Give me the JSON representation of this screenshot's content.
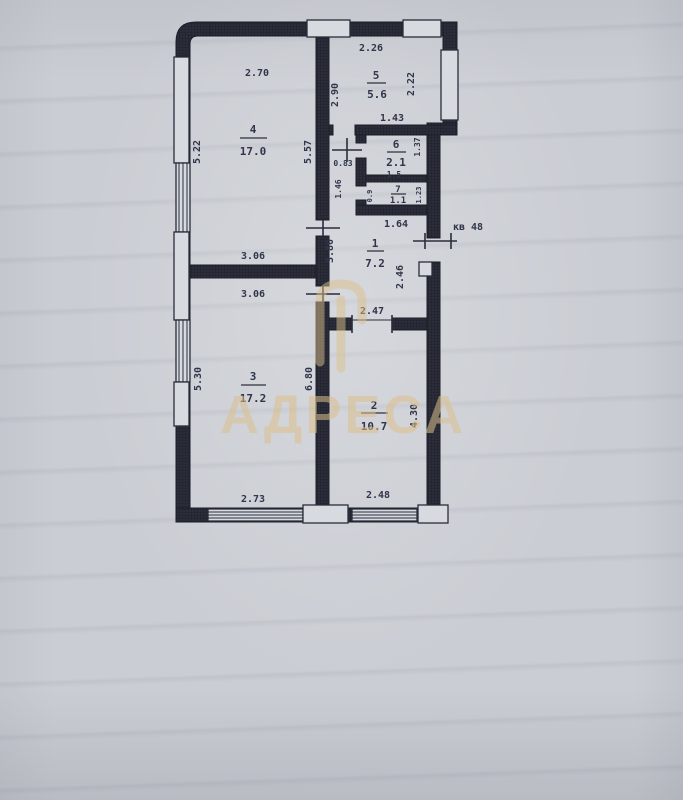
{
  "watermark": {
    "text": "АДРЕСА"
  },
  "annotations": {
    "apartment": "кв 48"
  },
  "rooms": [
    {
      "number": "1",
      "area": "7.2"
    },
    {
      "number": "2",
      "area": "10.7"
    },
    {
      "number": "3",
      "area": "17.2"
    },
    {
      "number": "4",
      "area": "17.0"
    },
    {
      "number": "5",
      "area": "5.6"
    },
    {
      "number": "6",
      "area": "2.1"
    },
    {
      "number": "7",
      "area": "1.1"
    }
  ],
  "dims": {
    "r4_top": "2.70",
    "left_upper": "5.22",
    "r4_right": "5.57",
    "r43_upper": "3.06",
    "r43_lower": "3.06",
    "left_lower": "5.30",
    "r3_right": "6.80",
    "r3_bottom": "2.73",
    "kitchen_top": "2.26",
    "kitchen_left": "2.90",
    "kitchen_right": "2.22",
    "bath_top": "1.43",
    "bath_right": "1.37",
    "bath_inner": "1.5",
    "passage_left": "1.46",
    "door_width": "0.83",
    "hall_top": "1.64",
    "hall_left": "3.80",
    "hall_right": "2.46",
    "r2_top": "2.47",
    "r2_right": "4.30",
    "r2_bottom": "2.48",
    "wc_left": "0.9",
    "wc_right": "1.23"
  }
}
